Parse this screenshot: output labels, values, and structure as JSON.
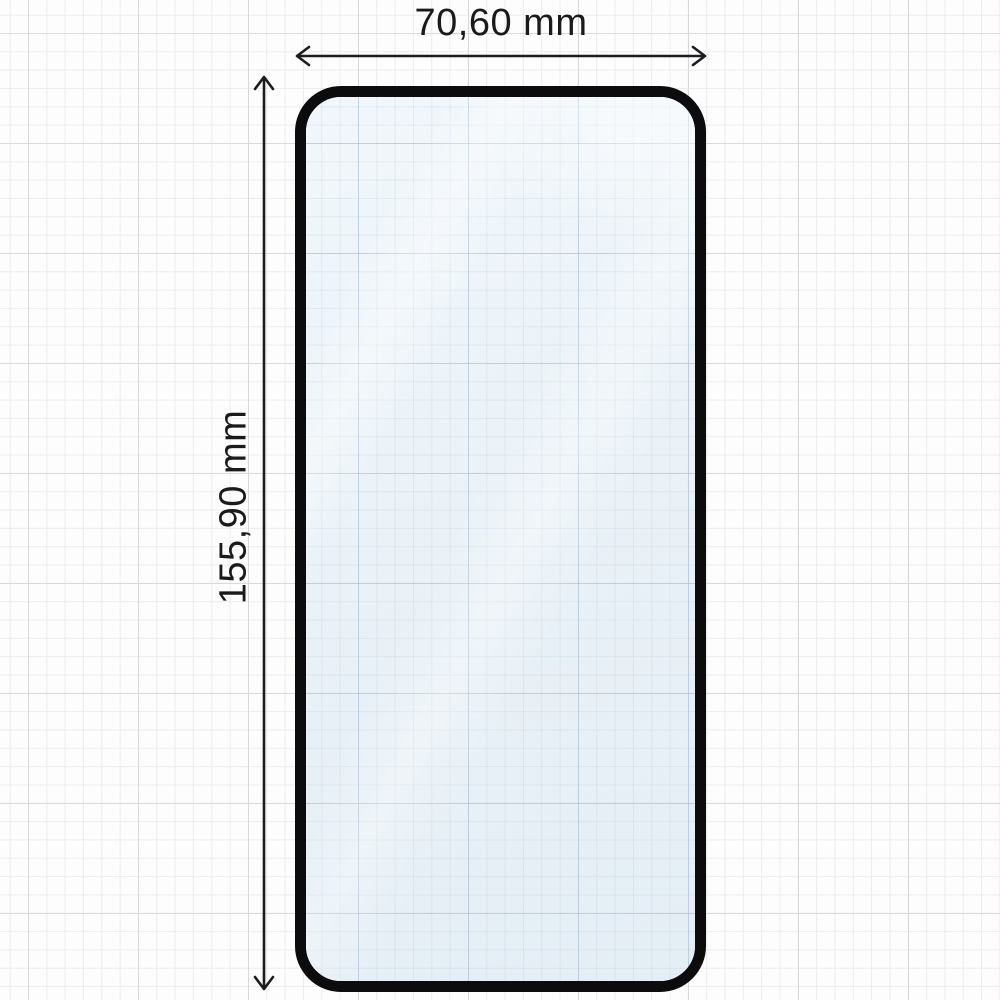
{
  "diagram": {
    "subject": "tempered-glass-screen-protector-outline",
    "width_dimension": {
      "label": "70,60 mm",
      "value_mm": 70.6,
      "unit": "mm"
    },
    "height_dimension": {
      "label": "155,90 mm",
      "value_mm": 155.9,
      "unit": "mm"
    }
  },
  "icons": {
    "width_arrow": "double-headed-horizontal-arrow",
    "height_arrow": "double-headed-vertical-arrow"
  },
  "colors": {
    "page_background": "#fdfdfd",
    "grid_minor": "#efecec",
    "grid_major": "#d8d8dd",
    "glass_fill": "#ecf3f8",
    "glass_border": "#0c0c0e",
    "dimension_ink": "#1c1c1e"
  }
}
